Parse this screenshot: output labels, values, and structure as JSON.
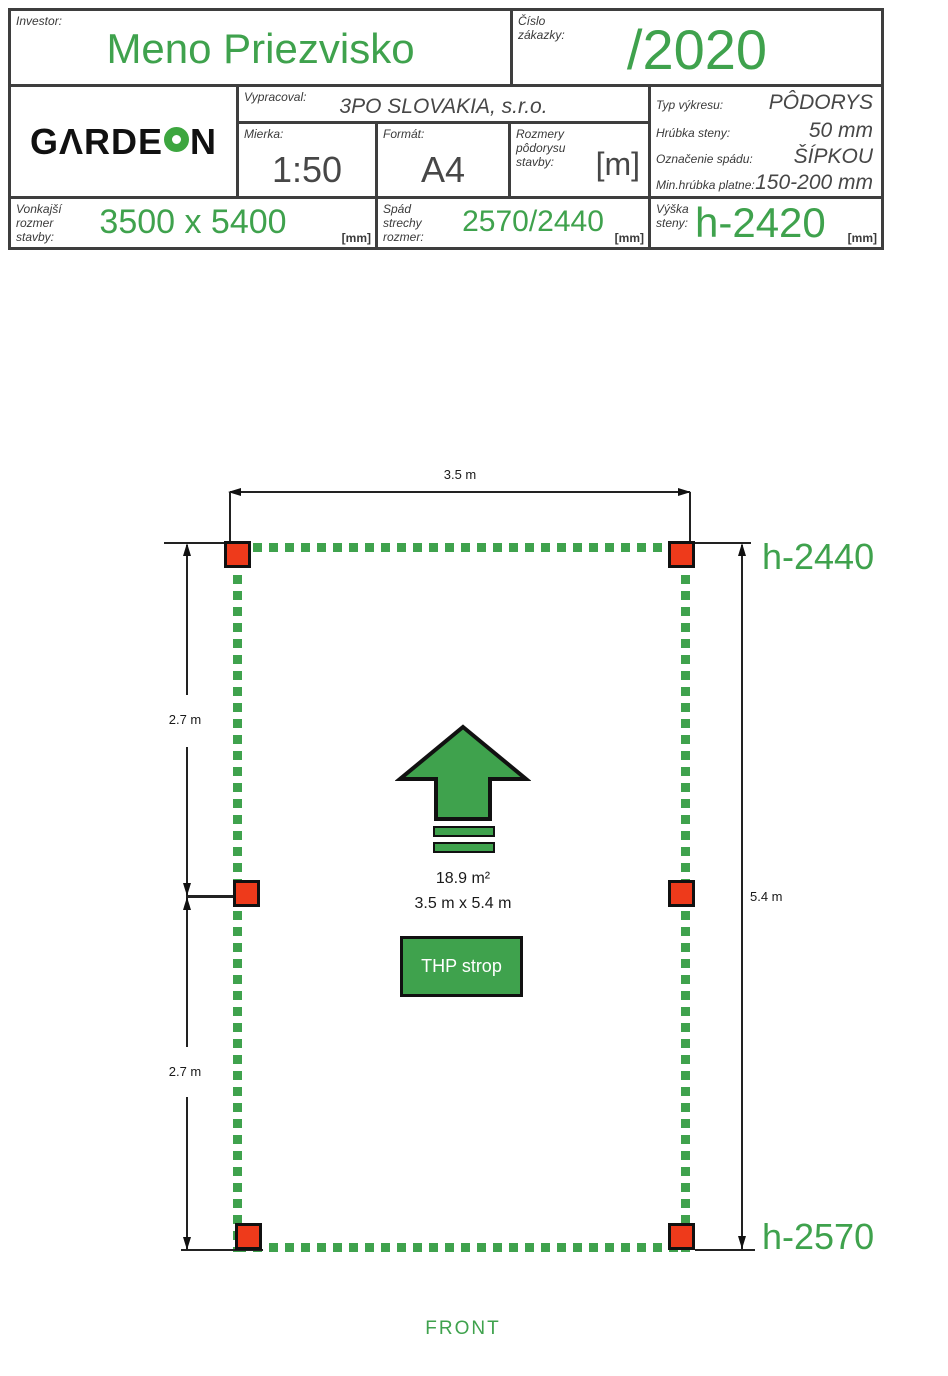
{
  "colors": {
    "green": "#3fa24d",
    "logo_green": "#3da63f",
    "red": "#ee3a1b",
    "frame": "#3e3e3e"
  },
  "title_block": {
    "investor": {
      "label": "Investor:",
      "value": "Meno Priezvisko"
    },
    "order": {
      "label": "Číslo zákazky:",
      "value": "/2020"
    },
    "logo": {
      "text": "GARDEON",
      "left": "GΛRDE",
      "right": "N",
      "o_icon": "green-donut"
    },
    "vypracoval": {
      "label": "Vypracoval:",
      "value": "3PO SLOVAKIA, s.r.o."
    },
    "mierka": {
      "label": "Mierka:",
      "value": "1:50"
    },
    "format": {
      "label": "Formát:",
      "value": "A4"
    },
    "rozmery": {
      "label": "Rozmery pôdorysu stavby:",
      "value": "[m]"
    },
    "specs": [
      {
        "label": "Typ výkresu:",
        "value": "PÔDORYS"
      },
      {
        "label": "Hrúbka steny:",
        "value": "50 mm"
      },
      {
        "label": "Označenie spádu:",
        "value": "ŠÍPKOU"
      },
      {
        "label": "Min.hrúbka platne:",
        "value": "150-200 mm"
      }
    ],
    "vonkajsi": {
      "label": "Vonkajší rozmer stavby:",
      "value": "3500 x 5400",
      "unit": "[mm]"
    },
    "spad": {
      "label": "Spád strechy rozmer:",
      "value": "2570/2440",
      "unit": "[mm]"
    },
    "vyska": {
      "label": "Výška steny:",
      "value": "h-2420",
      "unit": "[mm]"
    }
  },
  "plan": {
    "dim_top": "3.5 m",
    "dim_left_upper": "2.7 m",
    "dim_left_lower": "2.7 m",
    "dim_right": "5.4 m",
    "height_top": "h-2440",
    "height_bottom": "h-2570",
    "area": "18.9 m²",
    "size": "3.5 m x 5.4 m",
    "ceiling_label": "THP strop",
    "front_label": "FRONT"
  }
}
